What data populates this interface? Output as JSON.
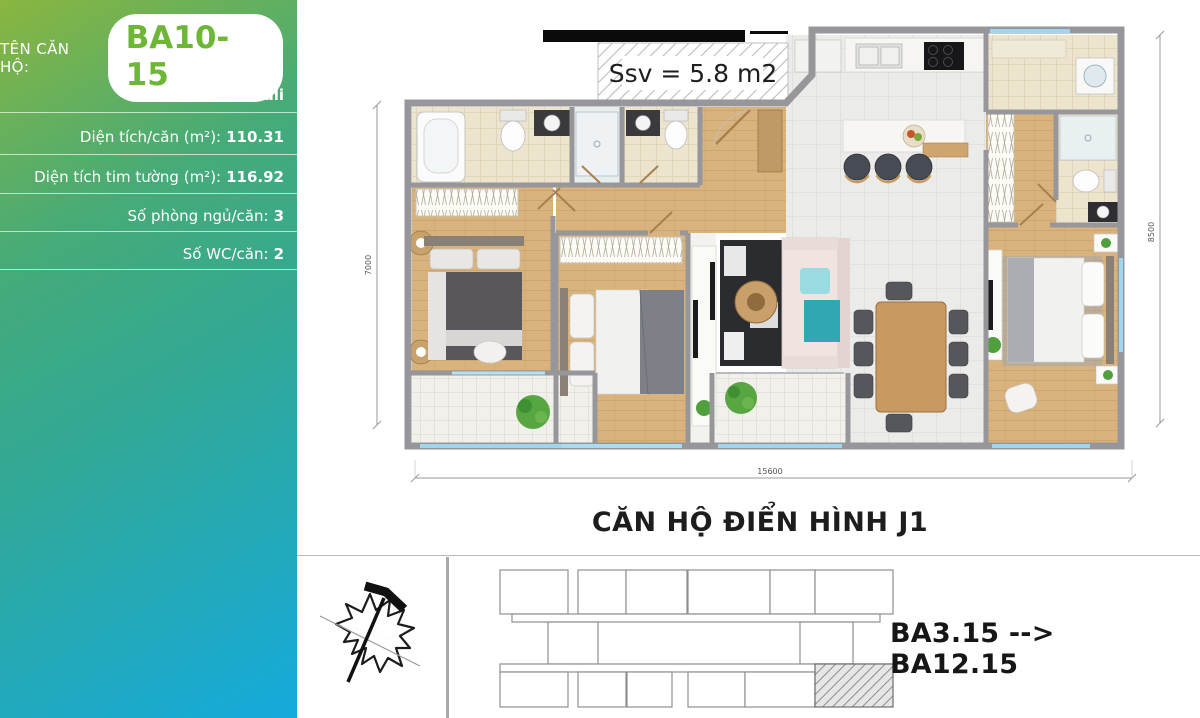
{
  "sidebar": {
    "name_label": "TÊN CĂN HỘ:",
    "unit_name": "BA10-15",
    "rows": {
      "block_label": "Khối nhà:",
      "block_value": "Bali",
      "area_label": "Diện tích/căn (m²):",
      "area_value": "110.31",
      "tim_label": "Diện tích tim tường (m²):",
      "tim_value": "116.92",
      "bedrooms_label": "Số phòng ngủ/căn:",
      "bedrooms_value": "3",
      "wc_label": "Số WC/căn:",
      "wc_value": "2"
    }
  },
  "floor_plan": {
    "ssv_label": "Ssv = 5.8 m2",
    "dims": {
      "height_left": "7000",
      "height_right": "8500",
      "width_bottom": "15600"
    },
    "caption": "CĂN HỘ ĐIỂN HÌNH J1"
  },
  "location_diagram": {
    "unit_range": "BA3.15 --> BA12.15"
  },
  "colors": {
    "accent_green": "#6db636",
    "gradient_start": "#8ab63f",
    "gradient_mid": "#2fa899",
    "gradient_end": "#15aadd",
    "wall_gray": "#97979b",
    "wood_floor": "#d9b37e",
    "glass_blue": "#9fd6ee"
  }
}
